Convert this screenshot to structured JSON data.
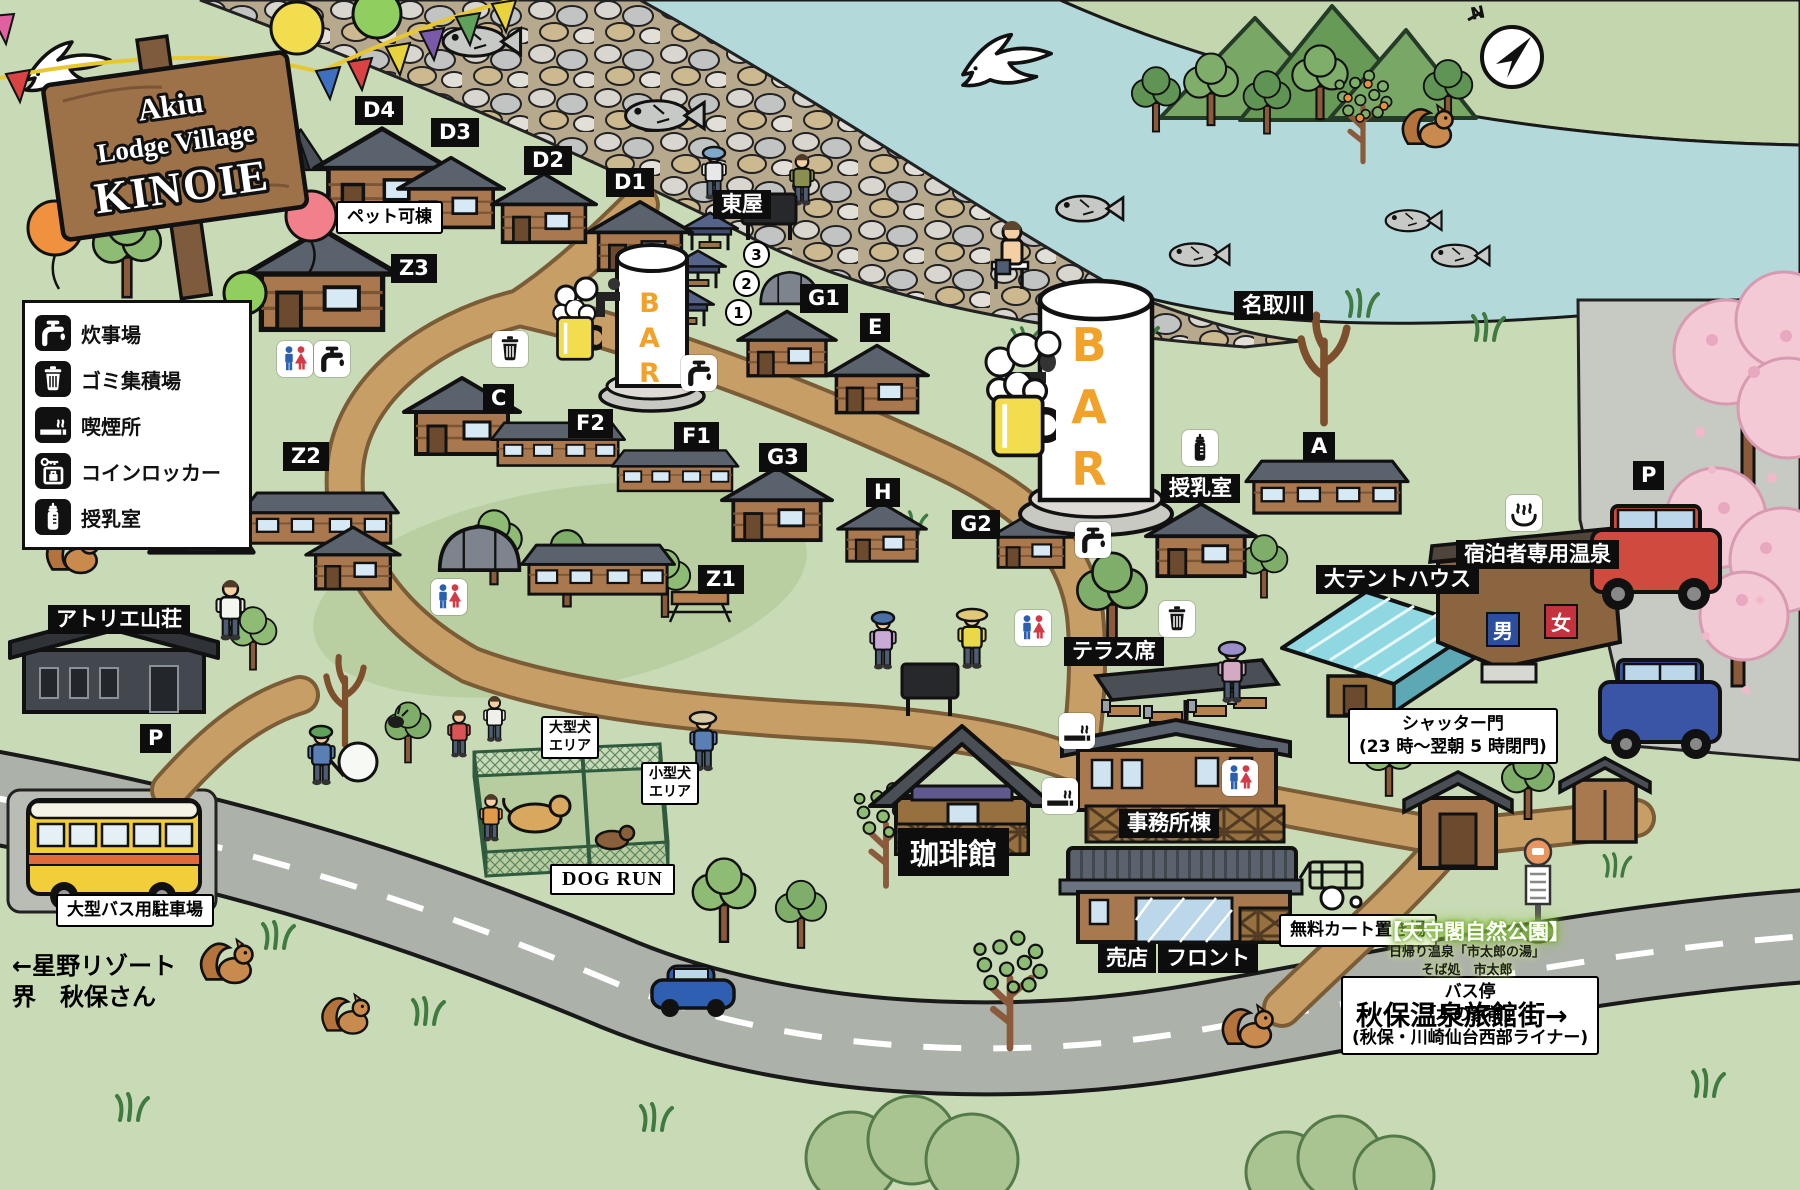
{
  "sign": {
    "line1": "Akiu",
    "line2": "Lodge Village",
    "line3": "KINOIE"
  },
  "compass": {
    "north": "N"
  },
  "bar_label": "BAR",
  "legend": {
    "items": [
      {
        "icon": "faucet",
        "label": "炊事場"
      },
      {
        "icon": "trash",
        "label": "ゴミ集積場"
      },
      {
        "icon": "smoking",
        "label": "喫煙所"
      },
      {
        "icon": "locker",
        "label": "コインロッカー"
      },
      {
        "icon": "bottle",
        "label": "授乳室"
      }
    ]
  },
  "map_labels": [
    {
      "name": "lodge-d4",
      "text": "D4",
      "x": 355,
      "y": 96,
      "kind": "chip"
    },
    {
      "name": "lodge-d3",
      "text": "D3",
      "x": 431,
      "y": 118,
      "kind": "chip"
    },
    {
      "name": "lodge-d2",
      "text": "D2",
      "x": 524,
      "y": 146,
      "kind": "chip"
    },
    {
      "name": "lodge-d1",
      "text": "D1",
      "x": 606,
      "y": 168,
      "kind": "chip"
    },
    {
      "name": "lodge-z3",
      "text": "Z3",
      "x": 391,
      "y": 254,
      "kind": "chip"
    },
    {
      "name": "azumaya",
      "text": "東屋",
      "x": 713,
      "y": 190,
      "kind": "chip"
    },
    {
      "name": "lodge-g1",
      "text": "G1",
      "x": 800,
      "y": 284,
      "kind": "chip"
    },
    {
      "name": "lodge-e",
      "text": "E",
      "x": 860,
      "y": 313,
      "kind": "chip"
    },
    {
      "name": "natori-river",
      "text": "名取川",
      "x": 1234,
      "y": 291,
      "kind": "chip"
    },
    {
      "name": "lodge-c",
      "text": "C",
      "x": 483,
      "y": 384,
      "kind": "chip"
    },
    {
      "name": "lodge-f2",
      "text": "F2",
      "x": 568,
      "y": 409,
      "kind": "chip"
    },
    {
      "name": "lodge-f1",
      "text": "F1",
      "x": 674,
      "y": 422,
      "kind": "chip"
    },
    {
      "name": "lodge-g3",
      "text": "G3",
      "x": 759,
      "y": 443,
      "kind": "chip"
    },
    {
      "name": "lodge-h",
      "text": "H",
      "x": 866,
      "y": 478,
      "kind": "chip"
    },
    {
      "name": "lodge-z2",
      "text": "Z2",
      "x": 283,
      "y": 442,
      "kind": "chip"
    },
    {
      "name": "lodge-g2",
      "text": "G2",
      "x": 952,
      "y": 510,
      "kind": "chip"
    },
    {
      "name": "lodge-z1",
      "text": "Z1",
      "x": 698,
      "y": 565,
      "kind": "chip"
    },
    {
      "name": "nursing-room",
      "text": "授乳室",
      "x": 1161,
      "y": 474,
      "kind": "chip"
    },
    {
      "name": "lodge-a",
      "text": "A",
      "x": 1303,
      "y": 432,
      "kind": "chip"
    },
    {
      "name": "large-tent-house",
      "text": "大テントハウス",
      "x": 1316,
      "y": 565,
      "kind": "chip"
    },
    {
      "name": "guest-only-onsen",
      "text": "宿泊者専用温泉",
      "x": 1456,
      "y": 540,
      "kind": "chip"
    },
    {
      "name": "terrace-seats",
      "text": "テラス席",
      "x": 1064,
      "y": 637,
      "kind": "chip"
    },
    {
      "name": "office-building",
      "text": "事務所棟",
      "x": 1119,
      "y": 809,
      "kind": "chip"
    },
    {
      "name": "coffee-house",
      "text": "珈琲館",
      "x": 898,
      "y": 828,
      "kind": "chip-big"
    },
    {
      "name": "shop",
      "text": "売店",
      "x": 1098,
      "y": 944,
      "kind": "chip"
    },
    {
      "name": "front-desk",
      "text": "フロント",
      "x": 1158,
      "y": 944,
      "kind": "chip"
    },
    {
      "name": "atelier-sanso",
      "text": "アトリエ山荘",
      "x": 48,
      "y": 605,
      "kind": "chip"
    },
    {
      "name": "parking-left",
      "text": "P",
      "x": 140,
      "y": 724,
      "kind": "chip"
    },
    {
      "name": "parking-right",
      "text": "P",
      "x": 1633,
      "y": 461,
      "kind": "chip"
    },
    {
      "name": "pet-allowed",
      "text": "ペット可棟",
      "x": 336,
      "y": 201,
      "kind": "white"
    },
    {
      "name": "large-dog-area",
      "text": "大型犬\nエリア",
      "x": 541,
      "y": 716,
      "kind": "white-sm"
    },
    {
      "name": "small-dog-area",
      "text": "小型犬\nエリア",
      "x": 641,
      "y": 762,
      "kind": "white-sm"
    },
    {
      "name": "dog-run",
      "text": "DOG RUN",
      "x": 550,
      "y": 864,
      "kind": "white-en"
    },
    {
      "name": "shutter-gate",
      "text": "シャッター門\n(23 時〜翌朝 5 時閉門)",
      "x": 1348,
      "y": 708,
      "kind": "white"
    },
    {
      "name": "free-cart-area",
      "text": "無料カート置き場",
      "x": 1279,
      "y": 914,
      "kind": "white"
    },
    {
      "name": "bus-stop",
      "text": "バス停\n「木の家前」\n(秋保・川崎仙台西部ライナー)",
      "x": 1341,
      "y": 976,
      "kind": "white"
    },
    {
      "name": "large-bus-parking",
      "text": "大型バス用駐車場",
      "x": 56,
      "y": 894,
      "kind": "white"
    },
    {
      "name": "hoshino-resort",
      "text": "←星野リゾート\n界　秋保さん",
      "x": 12,
      "y": 951,
      "kind": "plain"
    },
    {
      "name": "akiu-onsen-street",
      "text": "秋保温泉旅館街→",
      "x": 1356,
      "y": 994,
      "kind": "plain-big"
    },
    {
      "name": "tenshukaku-park",
      "text": "【天守閣自然公園】",
      "x": 1381,
      "y": 916,
      "kind": "glow"
    },
    {
      "name": "tenshukaku-detail",
      "text": "日帰り温泉「市太郎の湯」\nそば処　市太郎",
      "x": 1389,
      "y": 944,
      "kind": "sub"
    },
    {
      "name": "gazebo-3",
      "text": "3",
      "x": 743,
      "y": 241,
      "kind": "circle-num"
    },
    {
      "name": "gazebo-2",
      "text": "2",
      "x": 733,
      "y": 270,
      "kind": "circle-num"
    },
    {
      "name": "gazebo-1",
      "text": "1",
      "x": 725,
      "y": 299,
      "kind": "circle-num"
    },
    {
      "name": "onsen-men",
      "text": "男",
      "x": 1486,
      "y": 612,
      "kind": "door-m"
    },
    {
      "name": "onsen-women",
      "text": "女",
      "x": 1544,
      "y": 604,
      "kind": "door-w"
    }
  ],
  "map_icons": [
    {
      "type": "trash",
      "x": 492,
      "y": 331
    },
    {
      "type": "faucet",
      "x": 681,
      "y": 355
    },
    {
      "type": "restroom",
      "x": 277,
      "y": 341
    },
    {
      "type": "faucet",
      "x": 314,
      "y": 341
    },
    {
      "type": "faucet",
      "x": 1075,
      "y": 522
    },
    {
      "type": "trash",
      "x": 1159,
      "y": 601
    },
    {
      "type": "restroom",
      "x": 1015,
      "y": 610
    },
    {
      "type": "restroom",
      "x": 431,
      "y": 579
    },
    {
      "type": "restroom",
      "x": 1222,
      "y": 760
    },
    {
      "type": "smoking",
      "x": 1059,
      "y": 713
    },
    {
      "type": "smoking",
      "x": 1042,
      "y": 778
    },
    {
      "type": "bottle",
      "x": 1182,
      "y": 430
    },
    {
      "type": "onsen",
      "x": 1506,
      "y": 495
    }
  ]
}
